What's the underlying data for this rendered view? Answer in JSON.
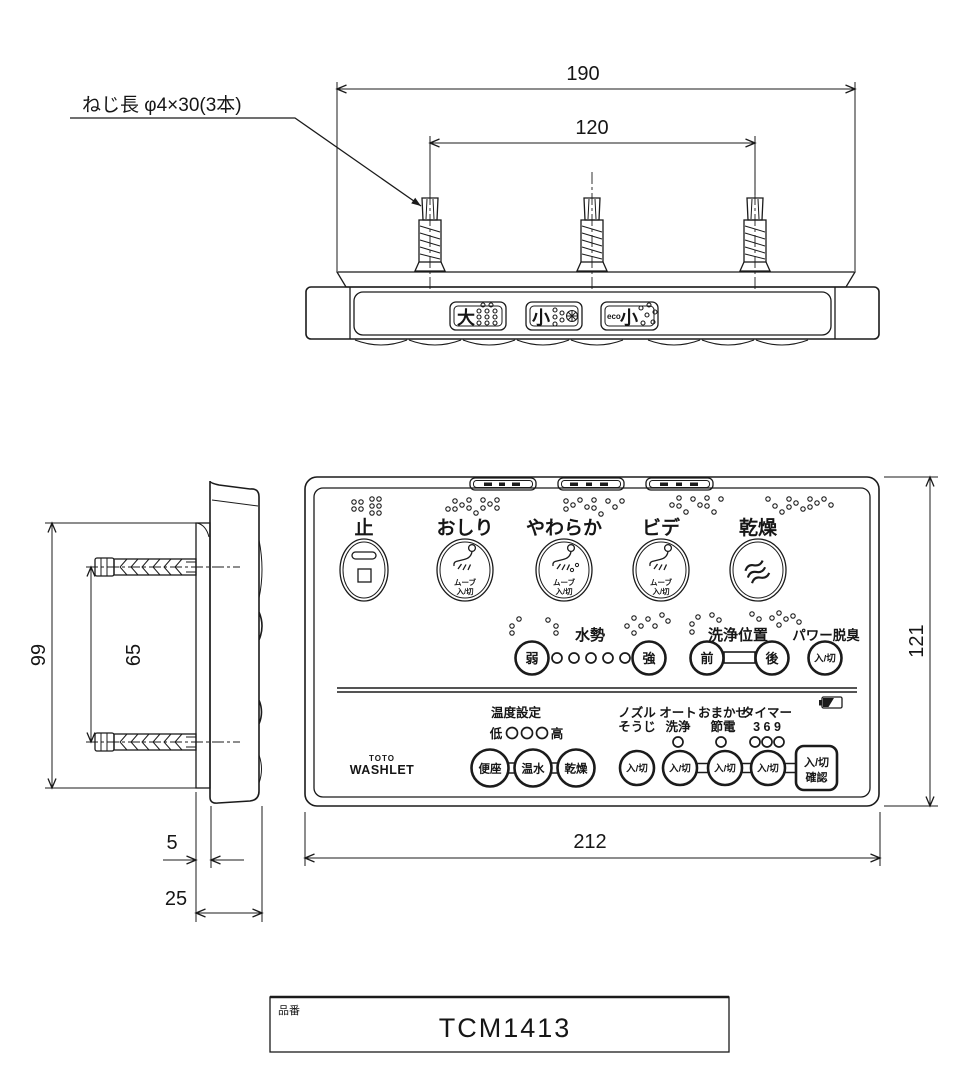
{
  "drawing": {
    "screw_note": "ねじ長  φ4×30(3本)",
    "dims": {
      "overall_width": "190",
      "screw_pitch_h": "120",
      "plate_height": "99",
      "screw_pitch_v": "65",
      "plate_thickness": "5",
      "body_depth": "25",
      "body_width": "212",
      "body_height": "121"
    }
  },
  "top_view": {
    "flush_big": "大",
    "flush_small": "小",
    "flush_eco_prefix": "eco",
    "flush_eco_kanji": "小"
  },
  "front_panel": {
    "row1": {
      "stop": "止",
      "rear": "おしり",
      "soft": "やわらか",
      "bidet": "ビデ",
      "dry": "乾燥",
      "move": "ムーブ",
      "onoff": "入/切"
    },
    "row2": {
      "water_pressure": "水勢",
      "weak": "弱",
      "strong": "強",
      "position": "洗浄位置",
      "front": "前",
      "back": "後",
      "deodorizer": "パワー脱臭",
      "onoff": "入/切"
    },
    "row3": {
      "temp_setting": "温度設定",
      "low": "低",
      "high": "高",
      "seat": "便座",
      "warm_water": "温水",
      "dry": "乾燥",
      "nozzle1": "ノズル",
      "nozzle2": "そうじ",
      "auto1": "オート",
      "auto2": "洗浄",
      "saver1": "おまかせ",
      "saver2": "節電",
      "timer": "タイマー",
      "timer_nums": "3 6 9",
      "onoff": "入/切",
      "confirm1": "入/切",
      "confirm2": "確認"
    },
    "brand": {
      "toto": "TOTO",
      "washlet": "WASHLET"
    }
  },
  "title_block": {
    "label": "品番",
    "part_number": "TCM1413"
  },
  "colors": {
    "line": "#1b1b1b",
    "background": "#ffffff"
  }
}
